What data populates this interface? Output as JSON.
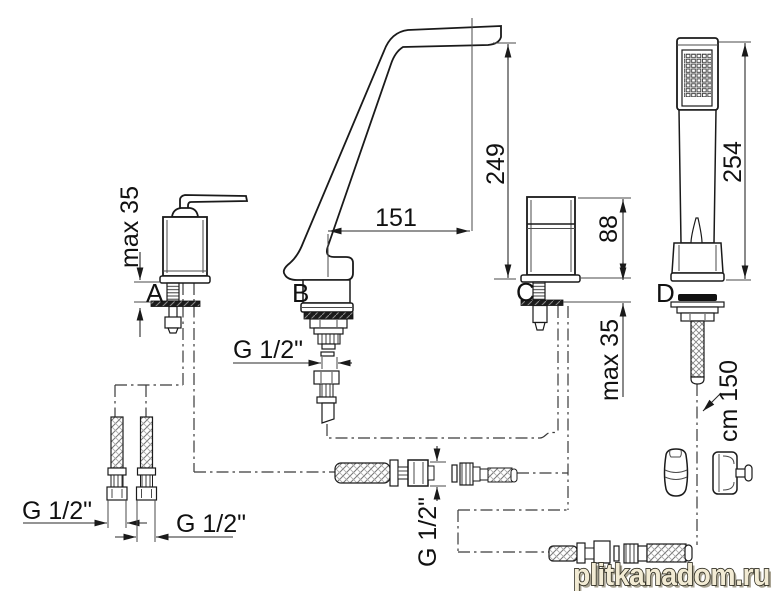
{
  "components": {
    "a": {
      "label": "A"
    },
    "b": {
      "label": "B"
    },
    "c": {
      "label": "C"
    },
    "d": {
      "label": "D"
    }
  },
  "dimensions": {
    "a_deck_max": "max 35",
    "spout_offset": "151",
    "spout_height": "249",
    "c_body_height": "88",
    "c_deck_max": "max 35",
    "handshower_height": "254",
    "hose_length": "cm 150",
    "b_thread": "G 1/2\"",
    "hose1_thread": "G 1/2\"",
    "hose2_thread": "G 1/2\"",
    "mid_connector_thread": "G 1/2\""
  },
  "watermark": {
    "text": "plitkanadom.ru"
  }
}
